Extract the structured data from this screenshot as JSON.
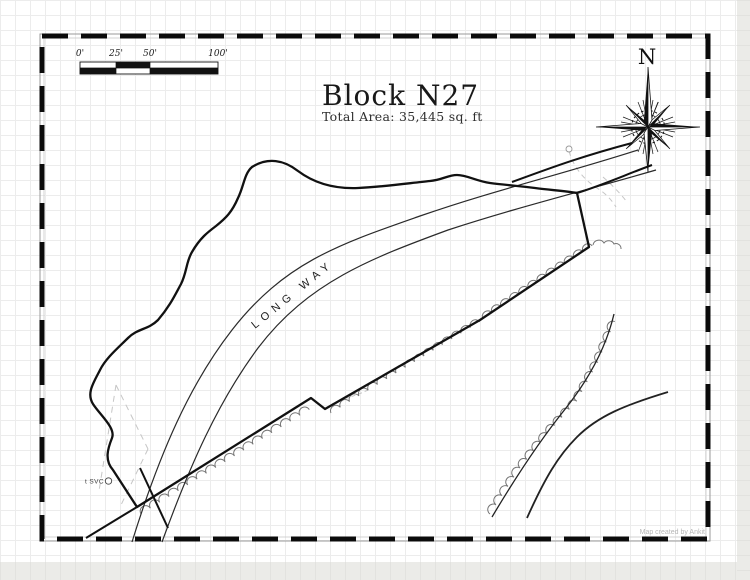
{
  "title": {
    "text": "Block N27",
    "subtitle": "Total Area: 35,445 sq. ft"
  },
  "scale": {
    "labels": [
      "0'",
      "25'",
      "50'",
      "100'"
    ]
  },
  "compass": {
    "n_label": "N"
  },
  "road": {
    "name": "LONG WAY"
  },
  "service": {
    "label": "t SVC"
  },
  "credit": {
    "text": "Map created by Ankit"
  },
  "colors": {
    "ink": "#161616",
    "scallop": "#757575",
    "dashed_gray": "#c6c6c6",
    "grid": "#ececec"
  }
}
